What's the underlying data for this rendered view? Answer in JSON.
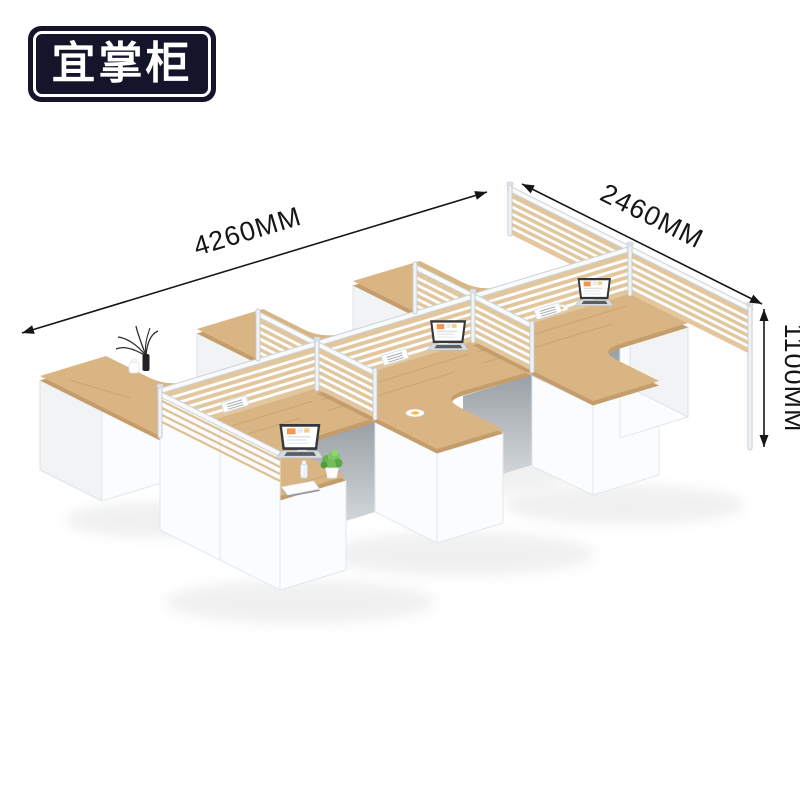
{
  "logo": {
    "text": "宜掌柜"
  },
  "dimensions": {
    "length": "4260MM",
    "depth": "2460MM",
    "height": "1100MM"
  },
  "scene": {
    "items": [
      "laptop",
      "laptop",
      "laptop",
      "plant-pot",
      "vase-with-leaves",
      "white-jar",
      "notebook",
      "water-bottle",
      "plate-with-food",
      "plate-with-food",
      "screen-organizer-tray"
    ]
  },
  "colors": {
    "wood": "#d9b584",
    "wood_edge": "#c49d6b",
    "screen_tan": "#e2c79e",
    "panel_white": "#fbfcfd",
    "under_desk_shadow_top": "#9aa1a6",
    "under_desk_shadow_bottom": "#d8dcdf",
    "dimension_ink": "#161616",
    "logo_background": "#14142a",
    "logo_text": "#ffffff",
    "laptop_screen_accent": "#f09750",
    "plant_green": "#72bf58",
    "plate_food_yellow": "#f3c95e"
  }
}
